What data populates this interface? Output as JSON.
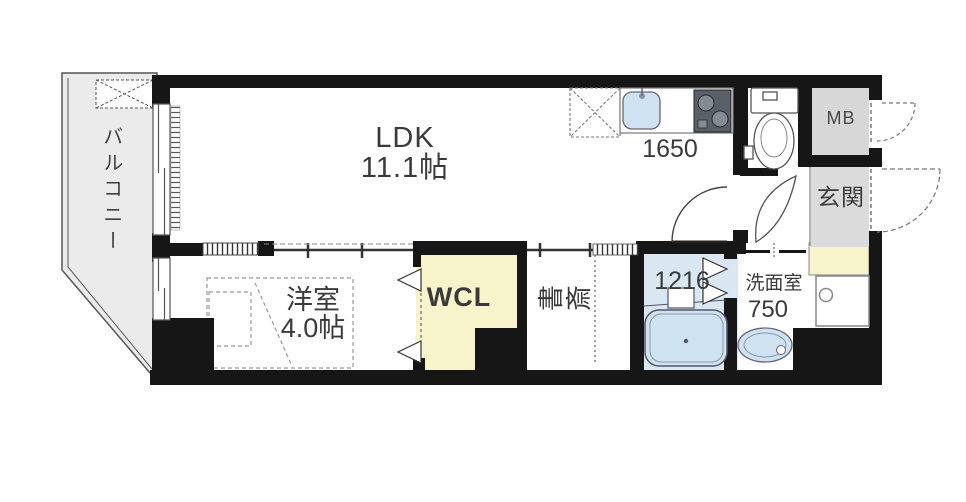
{
  "rooms": {
    "balcony": {
      "label": "バルコニー"
    },
    "ldk": {
      "name": "LDK",
      "size": "11.1帖"
    },
    "kitchen": {
      "counter_label": "1650"
    },
    "western_room": {
      "name": "洋室",
      "size": "4.0帖"
    },
    "walk_in_closet": {
      "label": "WCL"
    },
    "study": {
      "label": "書斎"
    },
    "bathroom": {
      "label": "1216"
    },
    "washroom": {
      "name": "洗面室",
      "size": "750"
    },
    "entrance": {
      "label": "玄関"
    },
    "meter_box": {
      "label": "MB"
    }
  },
  "colors": {
    "wall": "#161616",
    "line": "#4a4a4a",
    "balcony": "#ebebeb",
    "closet": "#f7f3cb",
    "bath": "#d9e7f3",
    "fixture": "#cfe2f1",
    "mb": "#d7d7d7",
    "genkan": "#dbdbdb",
    "stove": "#596068",
    "stove_burner": "#838b94"
  }
}
